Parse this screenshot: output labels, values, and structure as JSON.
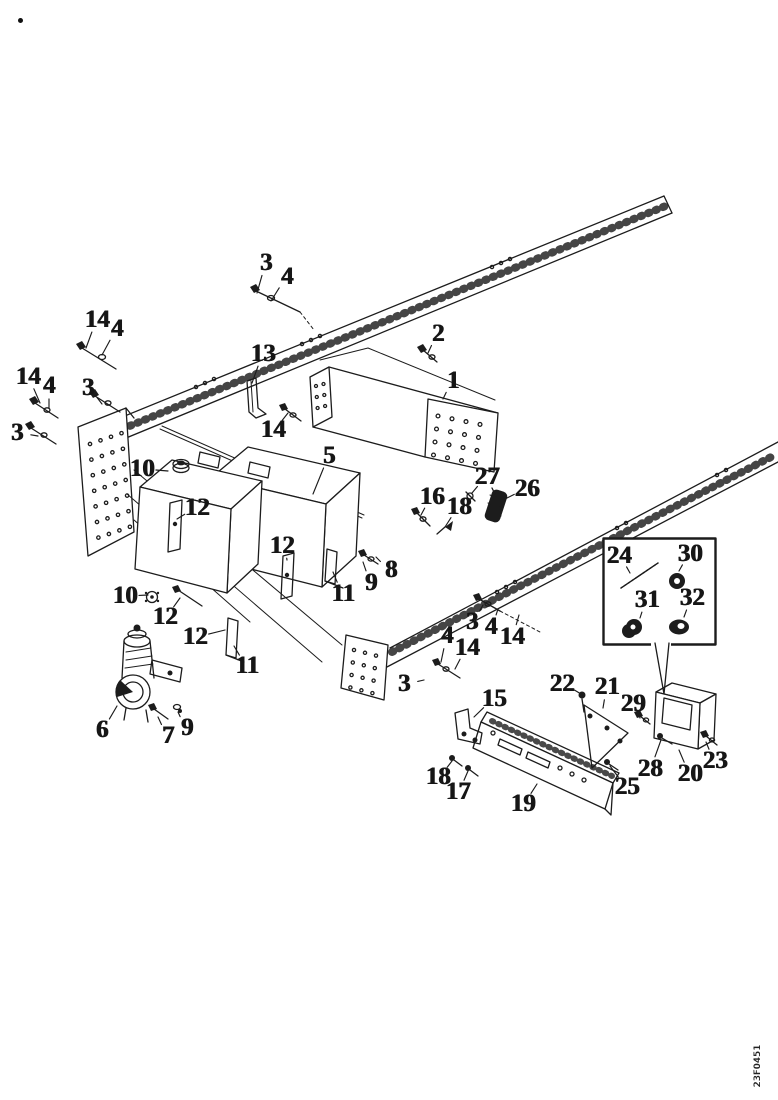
{
  "figure": {
    "type": "exploded-parts-diagram",
    "background": "#ffffff",
    "ink_color": "#1c1c1c",
    "footer_code": "23F0451",
    "callout_numbers_shown": [
      "1",
      "2",
      "3",
      "4",
      "5",
      "6",
      "7",
      "8",
      "9",
      "10",
      "11",
      "12",
      "13",
      "14",
      "15",
      "16",
      "17",
      "18",
      "19",
      "20",
      "21",
      "22",
      "23",
      "24",
      "25",
      "26",
      "27",
      "28",
      "29",
      "30",
      "31",
      "32"
    ],
    "inset": {
      "label_items": [
        "24",
        "30",
        "31",
        "32"
      ]
    },
    "callouts": [
      {
        "n": "3",
        "x": 266,
        "y": 263,
        "tx": 257,
        "ty": 293
      },
      {
        "n": "4",
        "x": 287,
        "y": 277,
        "tx": 271,
        "ty": 301
      },
      {
        "n": "14",
        "x": 97,
        "y": 320,
        "tx": 86,
        "ty": 348
      },
      {
        "n": "4",
        "x": 117,
        "y": 329,
        "tx": 102,
        "ty": 355
      },
      {
        "n": "3",
        "x": 88,
        "y": 388,
        "tx": 102,
        "ty": 404
      },
      {
        "n": "14",
        "x": 28,
        "y": 377,
        "tx": 40,
        "ty": 403
      },
      {
        "n": "4",
        "x": 49,
        "y": 386,
        "tx": 49,
        "ty": 408
      },
      {
        "n": "3",
        "x": 17,
        "y": 433,
        "tx": 38,
        "ty": 436
      },
      {
        "n": "13",
        "x": 263,
        "y": 354,
        "tx": 252,
        "ty": 383
      },
      {
        "n": "2",
        "x": 438,
        "y": 334,
        "tx": 428,
        "ty": 353
      },
      {
        "n": "1",
        "x": 453,
        "y": 381,
        "tx": 443,
        "ty": 399
      },
      {
        "n": "14",
        "x": 273,
        "y": 430,
        "tx": 288,
        "ty": 413
      },
      {
        "n": "10",
        "x": 142,
        "y": 469,
        "tx": 168,
        "ty": 471
      },
      {
        "n": "5",
        "x": 329,
        "y": 456,
        "tx": 313,
        "ty": 494
      },
      {
        "n": "12",
        "x": 197,
        "y": 508,
        "tx": 177,
        "ty": 519
      },
      {
        "n": "12",
        "x": 282,
        "y": 546,
        "tx": 287,
        "ty": 560
      },
      {
        "n": "16",
        "x": 432,
        "y": 497,
        "tx": 421,
        "ty": 515
      },
      {
        "n": "18",
        "x": 459,
        "y": 507,
        "tx": 445,
        "ty": 527
      },
      {
        "n": "27",
        "x": 487,
        "y": 477,
        "tx": 472,
        "ty": 493
      },
      {
        "n": "26",
        "x": 527,
        "y": 489,
        "tx": 505,
        "ty": 499
      },
      {
        "n": "10",
        "x": 125,
        "y": 596,
        "tx": 148,
        "ty": 595
      },
      {
        "n": "12",
        "x": 165,
        "y": 617,
        "tx": 180,
        "ty": 598
      },
      {
        "n": "12",
        "x": 195,
        "y": 637,
        "tx": 225,
        "ty": 630
      },
      {
        "n": "11",
        "x": 247,
        "y": 666,
        "tx": 234,
        "ty": 646
      },
      {
        "n": "11",
        "x": 343,
        "y": 594,
        "tx": 333,
        "ty": 572
      },
      {
        "n": "9",
        "x": 371,
        "y": 583,
        "tx": 363,
        "ty": 562
      },
      {
        "n": "8",
        "x": 391,
        "y": 570,
        "tx": 376,
        "ty": 557
      },
      {
        "n": "6",
        "x": 102,
        "y": 730,
        "tx": 117,
        "ty": 706
      },
      {
        "n": "7",
        "x": 168,
        "y": 736,
        "tx": 158,
        "ty": 717
      },
      {
        "n": "9",
        "x": 187,
        "y": 728,
        "tx": 178,
        "ty": 712
      },
      {
        "n": "3",
        "x": 472,
        "y": 622,
        "tx": 483,
        "ty": 605
      },
      {
        "n": "4",
        "x": 491,
        "y": 627,
        "tx": 498,
        "ty": 609
      },
      {
        "n": "14",
        "x": 512,
        "y": 637,
        "tx": 519,
        "ty": 615
      },
      {
        "n": "4",
        "x": 447,
        "y": 636,
        "tx": 441,
        "ty": 662
      },
      {
        "n": "14",
        "x": 467,
        "y": 648,
        "tx": 455,
        "ty": 669
      },
      {
        "n": "3",
        "x": 404,
        "y": 684,
        "tx": 424,
        "ty": 680
      },
      {
        "n": "15",
        "x": 494,
        "y": 699,
        "tx": 474,
        "ty": 717
      },
      {
        "n": "22",
        "x": 562,
        "y": 684,
        "tx": 581,
        "ty": 694
      },
      {
        "n": "21",
        "x": 607,
        "y": 687,
        "tx": 603,
        "ty": 708
      },
      {
        "n": "29",
        "x": 633,
        "y": 704,
        "tx": 640,
        "ty": 718
      },
      {
        "n": "23",
        "x": 715,
        "y": 761,
        "tx": 706,
        "ty": 742
      },
      {
        "n": "20",
        "x": 690,
        "y": 774,
        "tx": 679,
        "ty": 750
      },
      {
        "n": "28",
        "x": 650,
        "y": 769,
        "tx": 661,
        "ty": 740
      },
      {
        "n": "25",
        "x": 627,
        "y": 787,
        "tx": 610,
        "ty": 766
      },
      {
        "n": "18",
        "x": 438,
        "y": 777,
        "tx": 452,
        "ty": 761
      },
      {
        "n": "17",
        "x": 458,
        "y": 792,
        "tx": 468,
        "ty": 771
      },
      {
        "n": "19",
        "x": 523,
        "y": 804,
        "tx": 537,
        "ty": 784
      },
      {
        "n": "24",
        "x": 619,
        "y": 556,
        "tx": 630,
        "ty": 573
      },
      {
        "n": "30",
        "x": 690,
        "y": 554,
        "tx": 679,
        "ty": 571
      },
      {
        "n": "31",
        "x": 647,
        "y": 600,
        "tx": 640,
        "ty": 618
      },
      {
        "n": "32",
        "x": 692,
        "y": 598,
        "tx": 684,
        "ty": 617
      }
    ]
  }
}
